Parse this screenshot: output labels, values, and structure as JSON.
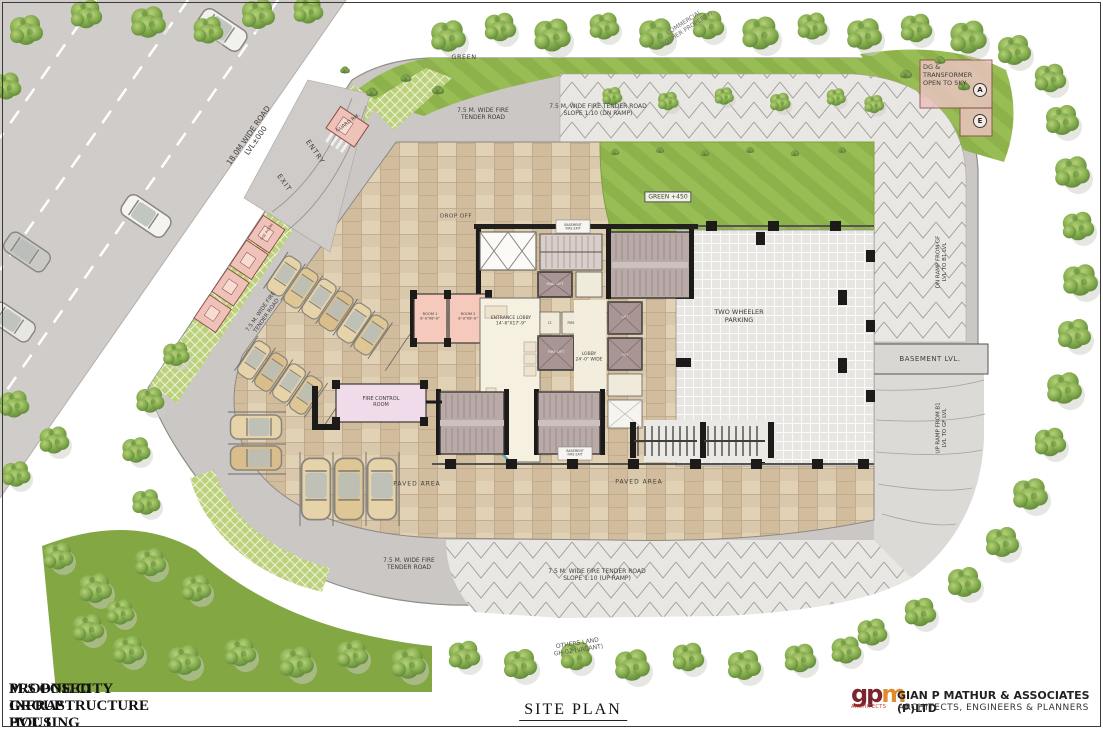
{
  "colors": {
    "road_gray": "#d0ccc9",
    "loop_road": "#cbc7c5",
    "lawn_green": "#8db24b",
    "paver_green": "#bcd17b",
    "paving_beige": "#dac8ac",
    "room_pink": "#f5cabc",
    "utility_pink": "#eec2b9",
    "lift_mauve": "#a99694",
    "glass_teal": "#55a8b4",
    "logo_maroon": "#7c2430",
    "logo_orange": "#e08b2d"
  },
  "roads": {
    "main_l1": "18.0M WIDE ROAD",
    "main_l2": "LVL±000",
    "entry": "ENTRY",
    "exit": "EXIT",
    "fire_l1": "7.5 M. WIDE FIRE",
    "fire_l2": "TENDER ROAD",
    "fire_full": "7.5 M. WIDE FIRE TENDER ROAD",
    "slope_dn": "SLOPE 1:10 (DN RAMP)",
    "slope_up": "SLOPE 1:10 (UP RAMP)",
    "dn_ramp_l1": "DN RAMP FROM GF",
    "dn_ramp_l2": "LVL TO B1 LVL",
    "up_ramp_l1": "UP RAMP FROM B1",
    "up_ramp_l2": "LVL TO GF LVL",
    "basement": "BASEMENT LVL."
  },
  "site": {
    "green": "GREEN",
    "green_450": "GREEN +450",
    "commercial_l1": "COMMERCIAL",
    "commercial_l2": "(OTHER PROPERTY)",
    "others_l1": "OTHERS LAND",
    "others_l2": "GH-02 (VACANT)",
    "dg_l1": "DG &",
    "dg_l2": "TRANSFORMER",
    "dg_l3": "OPEN TO SKY",
    "marker_a": "A",
    "marker_e": "E",
    "guard": "GUARD RM.",
    "soe": "SOE ROOM"
  },
  "building": {
    "drop_off": "DROP OFF",
    "two_wheeler_l1": "TWO WHEELER",
    "two_wheeler_l2": "PARKING",
    "paved": "PAVED AREA",
    "entrance_l1": "ENTRANCE LOBBY",
    "entrance_l2": "14'-6\"X17'-9\"",
    "lobby_l1": "LOBBY",
    "lobby_l2": "24'-0\" WIDE",
    "room1": "ROOM 1",
    "room2": "ROOM 2",
    "room_dim": "8'-0\"X8'-0\"",
    "fire_control_l1": "FIRE CONTROL",
    "fire_control_l2": "ROOM",
    "mail_lift": "MAIL LIFT",
    "fire_lift": "FIRE LIFT",
    "lift": "LIFT",
    "lt": "LT.",
    "fire_panel": "FIRE",
    "bfe_l1": "BASEMENT",
    "bfe_l2": "FIRE EXIT"
  },
  "title_block": {
    "line1": "PROPOSED GROUP HOUSING FOR",
    "line2": "M/S ONE CITY INFRASTRUCTURE PVT. L",
    "drawing_title": "SITE PLAN"
  },
  "firm": {
    "logo_main": "gp",
    "logo_m": "m",
    "logo_sub": "ARCHITECTS",
    "name": "GIAN P MATHUR & ASSOCIATES (P)LTD",
    "tagline": "ARCHITECTS, ENGINEERS & PLANNERS"
  }
}
